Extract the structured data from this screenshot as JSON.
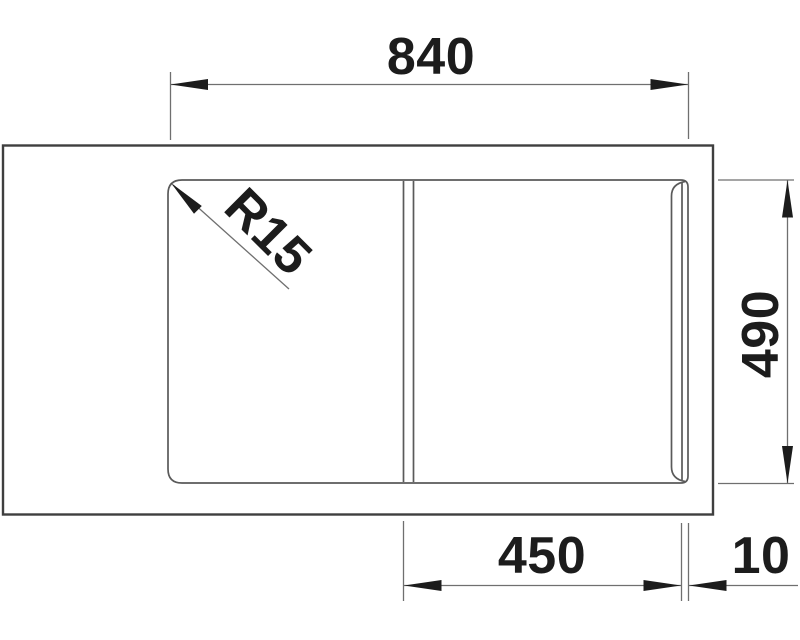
{
  "title": "Sink technical drawing, top view",
  "drawing": {
    "labels": {
      "overall_width": "840",
      "overall_depth": "490",
      "bowl_width": "450",
      "edge_gap": "10",
      "corner_radius": "R15"
    }
  },
  "colors": {
    "background": "#ffffff",
    "outline": "#3f3f3f",
    "inner_line": "#5a5a5a",
    "dim_line": "#6f6f6f",
    "text": "#1c1c1c"
  }
}
